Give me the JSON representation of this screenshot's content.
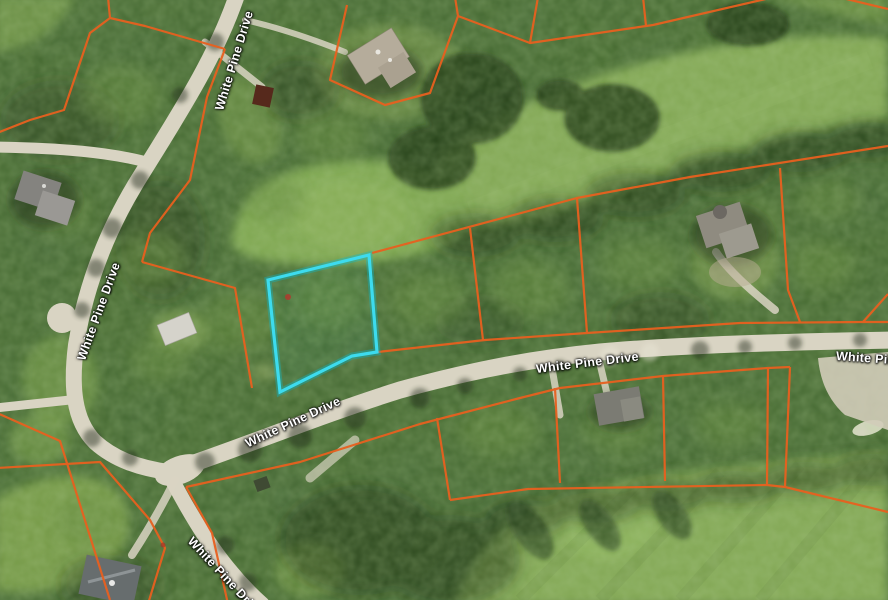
{
  "map": {
    "type": "satellite-parcel-map",
    "description": "Aerial view of wooded residential lots along a golf course",
    "road_labels": [
      {
        "text": "White Pine Drive",
        "orientation_deg": -73
      },
      {
        "text": "White Pine Drive",
        "orientation_deg": -70
      },
      {
        "text": "White Pine Drive",
        "orientation_deg": -25
      },
      {
        "text": "White Pine Drive",
        "orientation_deg": -7
      },
      {
        "text": "White Pine Drive",
        "orientation_deg": 47
      },
      {
        "text": "White Pine Drive",
        "orientation_deg": 4
      }
    ],
    "overlay": {
      "parcel_line_color": "#e8601f",
      "highlight_color": "#3ddbee",
      "subject_parcel_points": "268,280 369,255 377,352 352,356 280,392",
      "marker_color": "#b03a2e"
    },
    "terrain": {
      "forest_color": "#466b2f",
      "fairway_color": "#83a855",
      "road_color": "#d9d4c3"
    }
  }
}
